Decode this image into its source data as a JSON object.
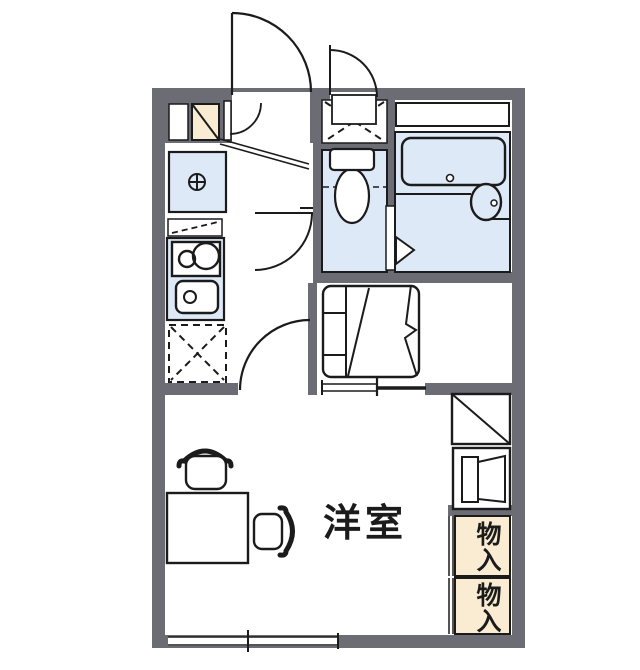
{
  "diagram_type": "apartment-floor-plan",
  "colors": {
    "wall": "#6c6c75",
    "water_fixture_fill": "#dde9f7",
    "storage_fill": "#f9ecd2",
    "line": "#1b1b1b",
    "background": "#ffffff"
  },
  "rooms": {
    "main_room": {
      "label": "洋室"
    },
    "storage_upper": {
      "label": "物入"
    },
    "storage_lower": {
      "label": "物入"
    }
  },
  "fixtures": [
    "entrance-door-swing",
    "shoe-cabinet",
    "wall-niche",
    "washing-machine-space",
    "kitchen-unit",
    "kitchen-counter",
    "two-burner-stove",
    "kitchen-sink",
    "refrigerator-space",
    "hallway-door-swing",
    "kitchen-door-swing",
    "toilet",
    "bathtub",
    "washbasin",
    "folding-bath-door",
    "staircase",
    "closet-shelf",
    "cabinet",
    "desk",
    "chair",
    "window"
  ]
}
